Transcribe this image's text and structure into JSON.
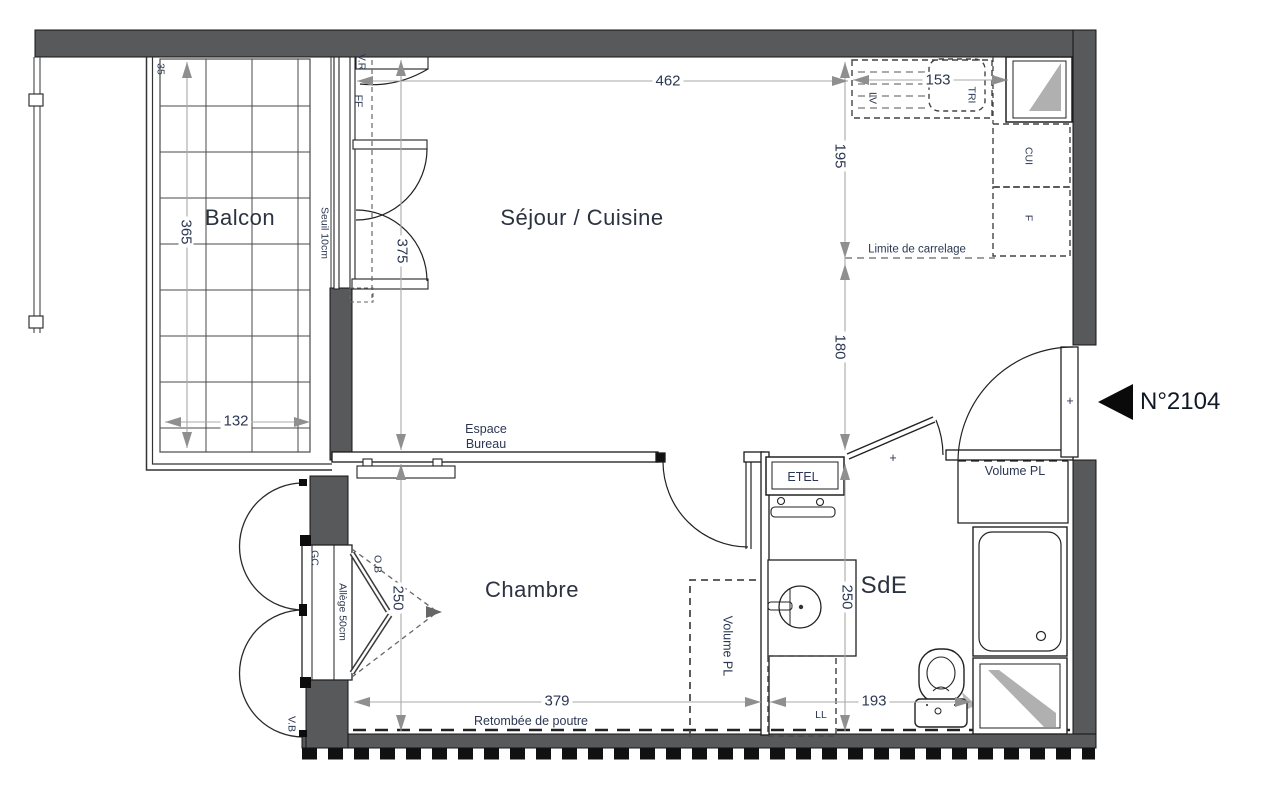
{
  "unit": {
    "number": "N°2104"
  },
  "rooms": {
    "balcon": "Balcon",
    "sejour_cuisine": "Séjour / Cuisine",
    "chambre": "Chambre",
    "sde": "SdE"
  },
  "annotations": {
    "limite_carrelage": "Limite de carrelage",
    "espace_bureau_line1": "Espace",
    "espace_bureau_line2": "Bureau",
    "retombee_poutre": "Retombée de poutre",
    "volume_pl_entree": "Volume PL",
    "volume_pl_chambre": "Volume PL",
    "etel": "ETEL",
    "seuil": "Seuil 10cm",
    "allege": "Allège 50cm",
    "lave_linge": "LL",
    "lave_vaisselle": "LV",
    "tri": "TRI",
    "cuisiniere": "CUI",
    "frigo": "F",
    "volet_roulant": "V.R",
    "fenetre_fixe": "FF",
    "gaine": "GC",
    "volet_battant": "V.B",
    "oscillo_battant": "O.B",
    "door_cross": "+"
  },
  "dimensions": {
    "d462": "462",
    "d153": "153",
    "d195": "195",
    "d180": "180",
    "d375": "375",
    "d365": "365",
    "d132": "132",
    "d35": "35",
    "d250_chambre": "250",
    "d250_sde": "250",
    "d379": "379",
    "d193": "193"
  },
  "colors": {
    "wall": "#58595b",
    "dim_line": "#a8a8a8",
    "text": "#2b3752",
    "line": "#222222",
    "window_mark": "#b0b0b0"
  }
}
